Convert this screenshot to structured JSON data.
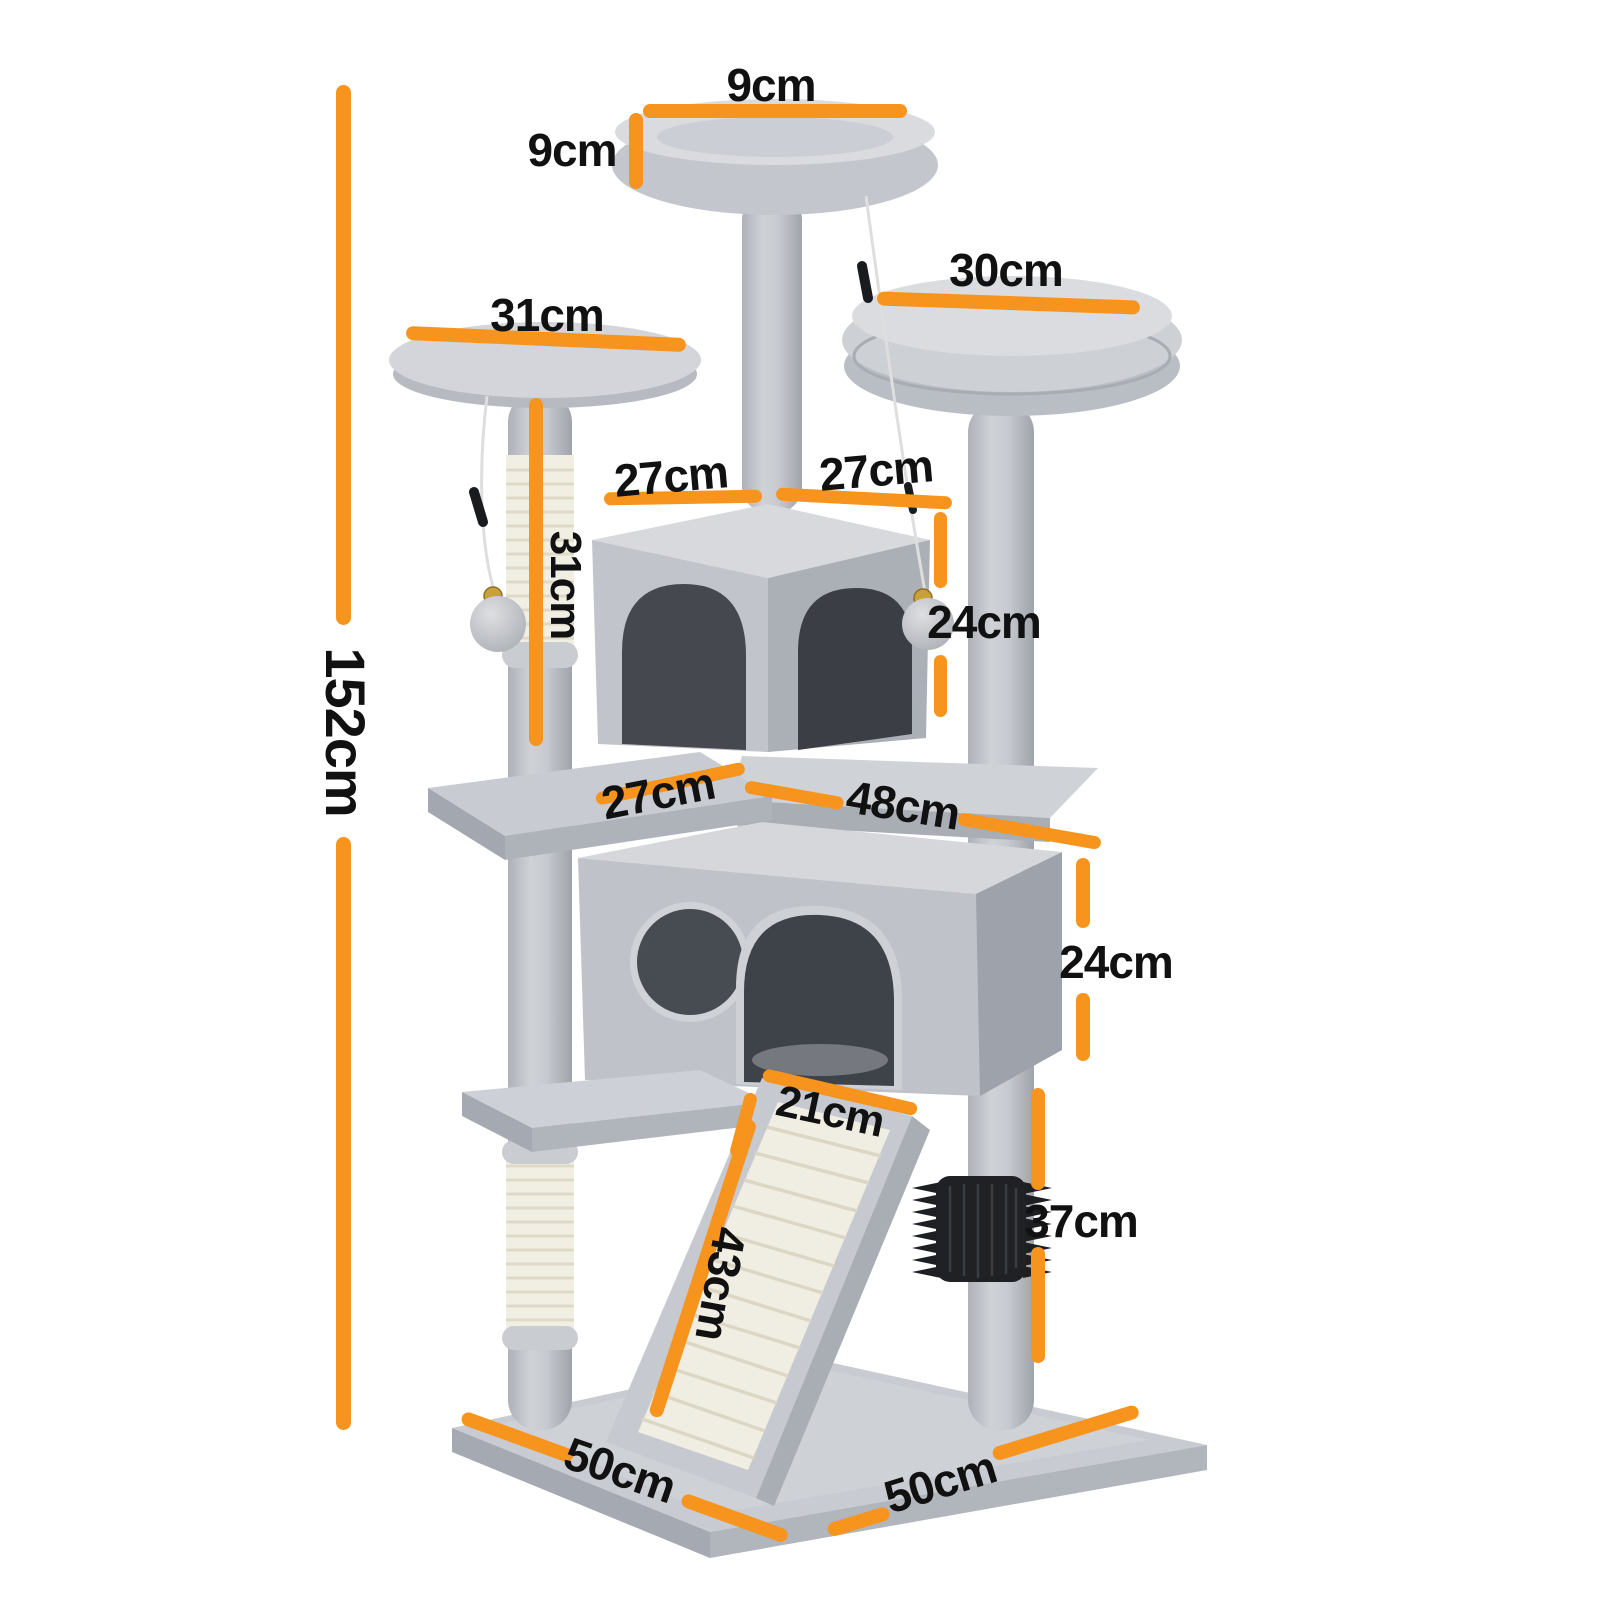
{
  "page": {
    "type": "product-dimension-diagram",
    "subject": "cat tree tower",
    "background": "#ffffff"
  },
  "style": {
    "accent_color": "#F7941E",
    "label_color": "#111111"
  },
  "product": {
    "parts": [
      "top-perch",
      "right-perch",
      "left-platform",
      "upper-condo-two-arches",
      "lower-condo-round-hole-and-arch",
      "sisal-scratching-posts",
      "sisal-scratch-ramp",
      "grooming-brush",
      "hanging-pompom-balls",
      "square-base"
    ]
  },
  "dimensions": {
    "top_perch_width": "9cm",
    "top_perch_height": "9cm",
    "right_perch_width": "30cm",
    "left_platform_width": "31cm",
    "upper_condo_width_left": "27cm",
    "upper_condo_width_right": "27cm",
    "left_post_height": "31cm",
    "total_height": "152cm",
    "upper_condo_height": "24cm",
    "middle_platform_width": "27cm",
    "middle_level_width": "48cm",
    "lower_condo_height": "24cm",
    "ramp_width": "21cm",
    "ramp_length": "43cm",
    "front_post_height": "37cm",
    "base_depth": "50cm",
    "base_width": "50cm"
  }
}
